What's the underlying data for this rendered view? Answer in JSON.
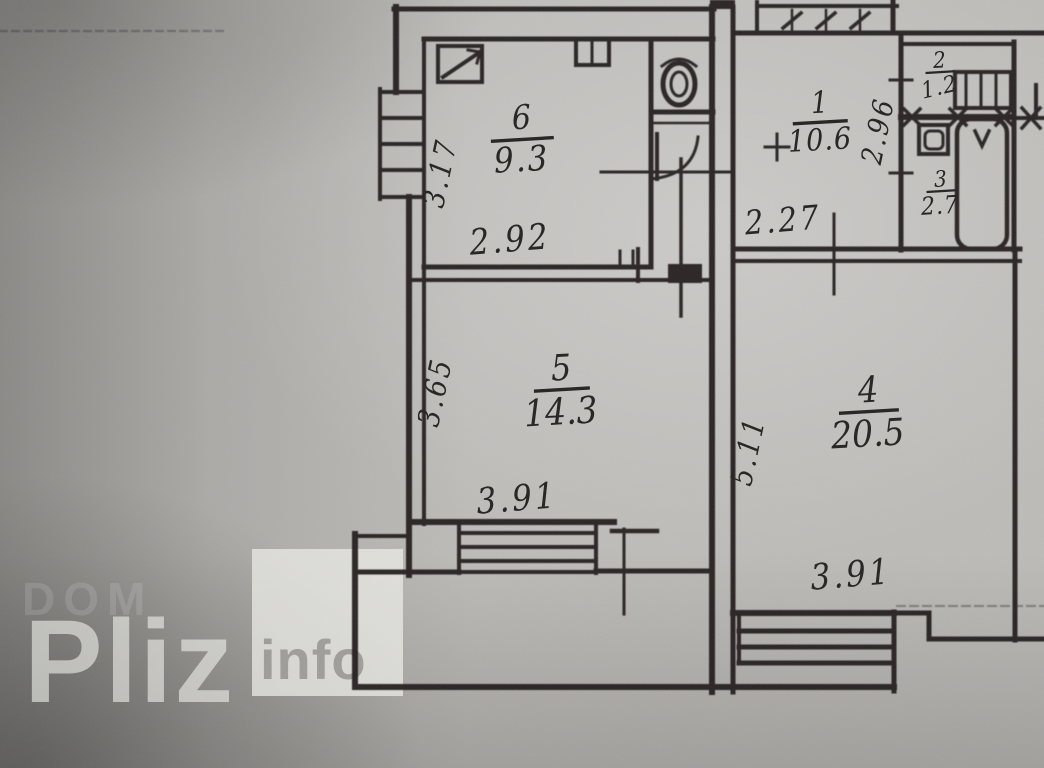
{
  "watermark": {
    "brand": "Pliz",
    "suffix": "info",
    "shadow_text": "DOM"
  },
  "rooms": {
    "r1": {
      "number": "1",
      "area": "10.6"
    },
    "r2": {
      "number": "2",
      "area": "1.2"
    },
    "r3": {
      "number": "3",
      "area": "2.7"
    },
    "r4": {
      "number": "4",
      "area": "20.5"
    },
    "r5": {
      "number": "5",
      "area": "14.3"
    },
    "r6": {
      "number": "6",
      "area": "9.3"
    }
  },
  "dimensions": {
    "room6_width": "2.92",
    "room6_depth": "3.17",
    "room1_width": "2.27",
    "room1_depth": "2.96",
    "room5_width": "3.91",
    "room5_depth": "3.65",
    "room4_width": "3.91",
    "room4_depth": "5.11"
  },
  "colors": {
    "paper": "#bdbcb9",
    "ink": "#201f1d",
    "watermark_text": "#f3f3f0",
    "watermark_box": "#ebeae6",
    "watermark_info": "#949390"
  }
}
